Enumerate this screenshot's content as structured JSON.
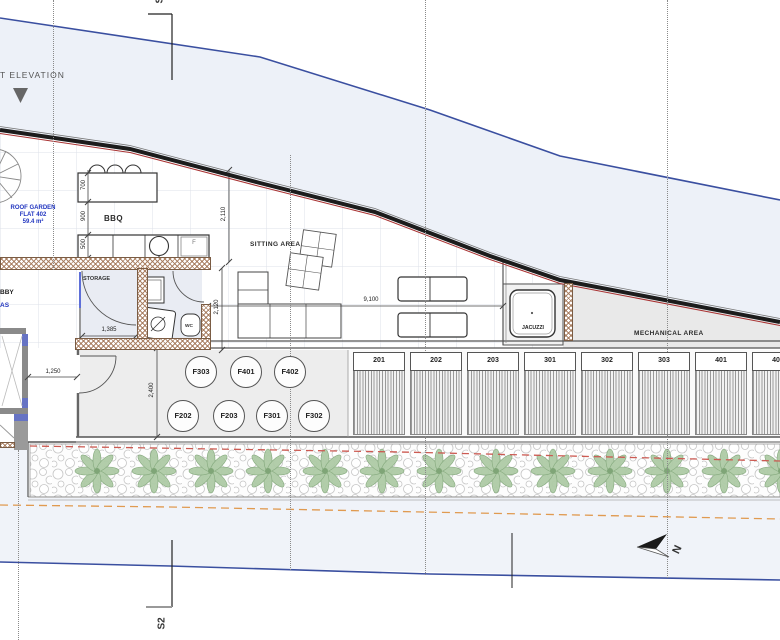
{
  "drawing": {
    "elevation_label": "T ELEVATION",
    "section_label_top": "S2",
    "section_label_bottom": "S2",
    "north_label": "N",
    "roof_garden": {
      "line1": "ROOF GARDEN",
      "line2": "FLAT 402",
      "line3": "59.4 m²"
    },
    "labels": {
      "bbq": "BBQ",
      "sitting_area": "SITTING AREA",
      "storage": "STORAGE",
      "wc": "WC",
      "jacuzzi": "JACUZZI",
      "mechanical_area": "MECHANICAL AREA",
      "lobby_partial": "BBY",
      "areas_partial": "AS",
      "fridge": "F"
    },
    "flat_circles": [
      "F303",
      "F401",
      "F402",
      "F202",
      "F203",
      "F301",
      "F302"
    ],
    "unit_panels": [
      "201",
      "202",
      "203",
      "301",
      "302",
      "303",
      "401",
      "402"
    ],
    "dimensions": {
      "table_width": "700",
      "table_gap": "900",
      "counter_depth": "500",
      "upper_height": "2,110",
      "lower_height": "2,120",
      "terrace_width": "9,100",
      "storage_width": "1,385",
      "lobby_width": "1,250",
      "room_height": "2,400"
    },
    "colors": {
      "contour_blue": "#3a4fa0",
      "shade_blue": "#edf1f8",
      "hatch_brown": "#a5795a",
      "parapet_red": "#a83232",
      "red_dashed": "#cc5a52",
      "orange_dashed": "#e09a50",
      "tree_green": "#a4c69c",
      "room_grey": "#ededed",
      "text_blue": "#2236c0"
    }
  }
}
